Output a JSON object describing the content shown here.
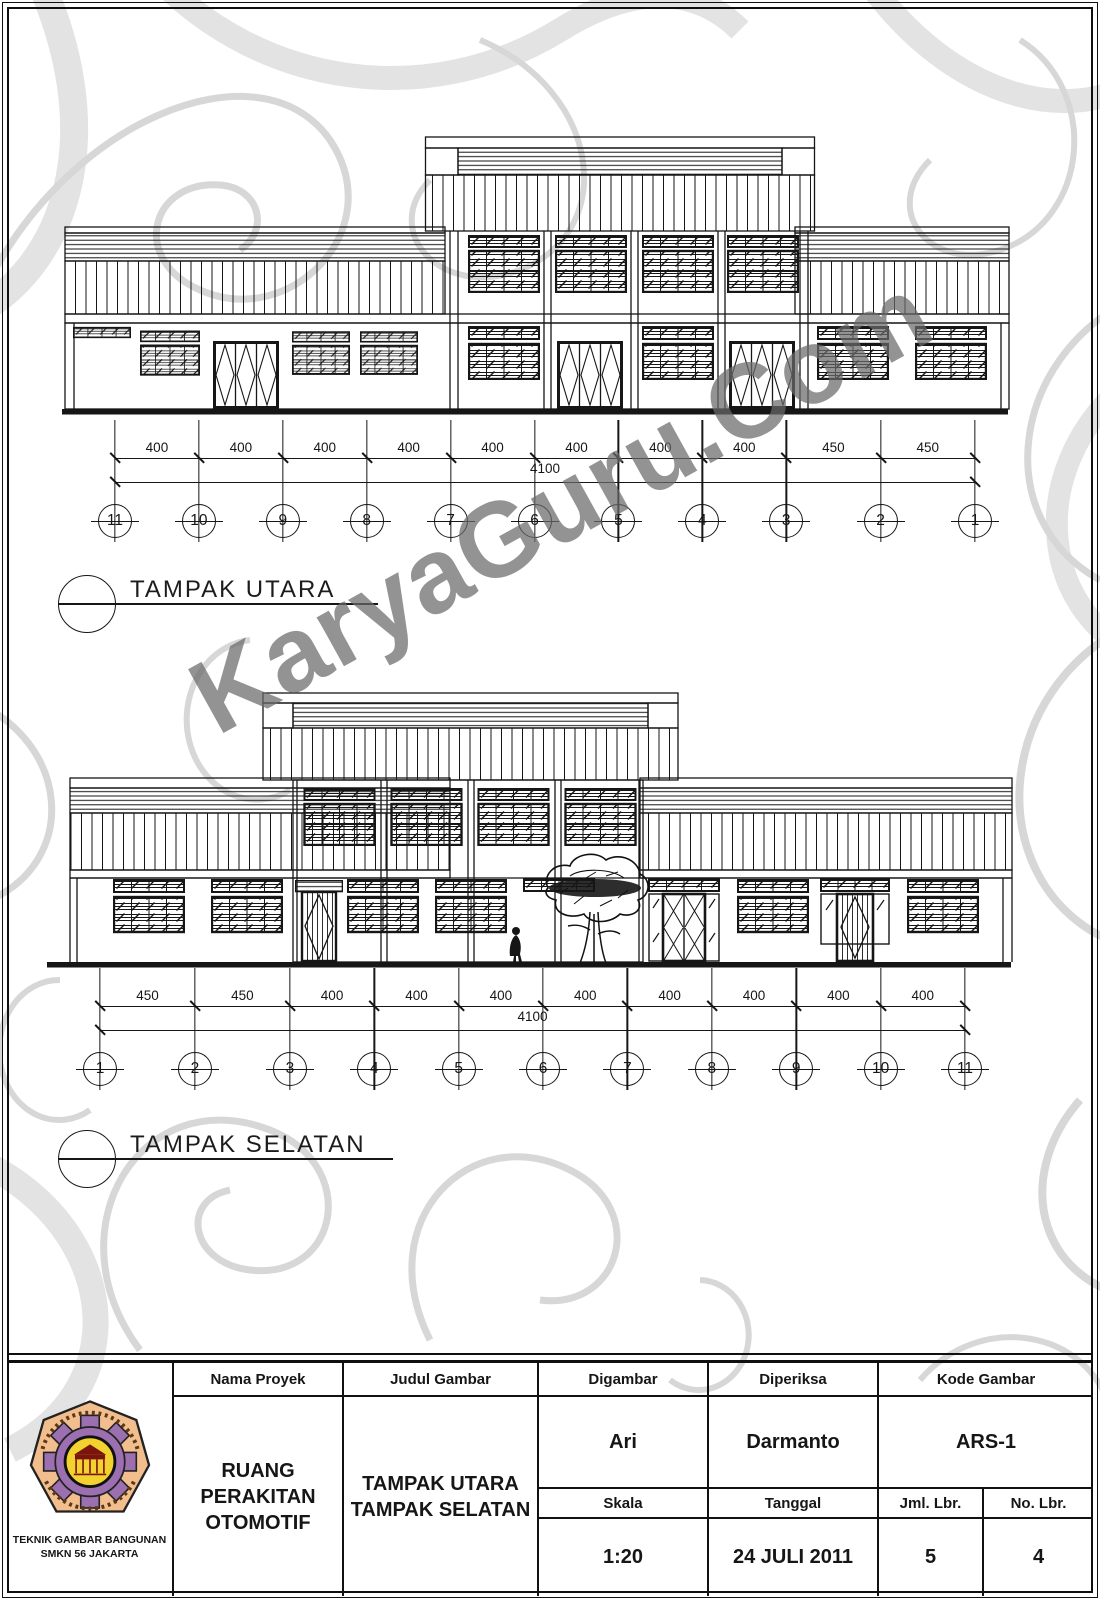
{
  "watermark": "KaryaGuru.Com",
  "north": {
    "title": "TAMPAK UTARA",
    "labels": [
      "11",
      "10",
      "9",
      "8",
      "7",
      "6",
      "5",
      "4",
      "3",
      "2",
      "1"
    ],
    "segments": [
      400,
      400,
      400,
      400,
      400,
      400,
      400,
      400,
      450,
      450
    ],
    "total": "4100"
  },
  "south": {
    "title": "TAMPAK SELATAN",
    "labels": [
      "1",
      "2",
      "3",
      "4",
      "5",
      "6",
      "7",
      "8",
      "9",
      "10",
      "11"
    ],
    "segments": [
      450,
      450,
      400,
      400,
      400,
      400,
      400,
      400,
      400,
      400
    ],
    "total": "4100"
  },
  "title_block": {
    "headers": {
      "nama_proyek": "Nama Proyek",
      "judul_gambar": "Judul Gambar",
      "digambar": "Digambar",
      "diperiksa": "Diperiksa",
      "kode_gambar": "Kode Gambar",
      "skala": "Skala",
      "tanggal": "Tanggal",
      "jml_lbr": "Jml. Lbr.",
      "no_lbr": "No. Lbr."
    },
    "values": {
      "nama_proyek_lines": [
        "RUANG",
        "PERAKITAN",
        "OTOMOTIF"
      ],
      "judul_gambar_lines": [
        "TAMPAK UTARA",
        "TAMPAK SELATAN"
      ],
      "digambar": "Ari",
      "diperiksa": "Darmanto",
      "kode_gambar": "ARS-1",
      "skala": "1:20",
      "tanggal": "24 JULI 2011",
      "jml_lbr": "5",
      "no_lbr": "4"
    },
    "logo_caption_lines": [
      "TEKNIK GAMBAR BANGUNAN",
      "SMKN 56 JAKARTA"
    ]
  }
}
